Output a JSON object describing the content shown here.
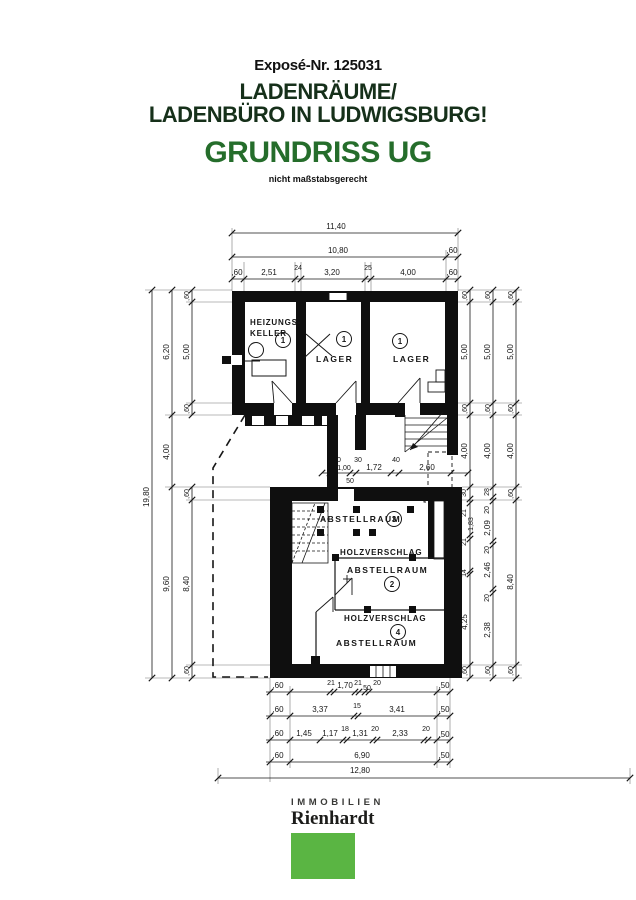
{
  "header": {
    "expose_no": "Exposé-Nr. 125031",
    "title_line1": "LADENRÄUME/",
    "title_line2": "LADENBÜRO IN LUDWIGSBURG!",
    "plan_title": "GRUNDRISS UG",
    "scale_note": "nicht maßstabsgerecht",
    "title_color": "#16301a",
    "plan_title_color": "#256d2b"
  },
  "plan": {
    "rooms": {
      "heizungskeller": {
        "label_line1": "HEIZUNGS-",
        "label_line2": "KELLER",
        "number": "1"
      },
      "lager_1": {
        "label": "LAGER",
        "number": "1"
      },
      "lager_2": {
        "label": "LAGER",
        "number": "1"
      },
      "abstellraum_3": {
        "label": "ABSTELLRAUM",
        "number": "3"
      },
      "holzverschlag_1": {
        "label": "HOLZVERSCHLAG"
      },
      "abstellraum_2": {
        "label": "ABSTELLRAUM",
        "number": "2"
      },
      "holzverschlag_2": {
        "label": "HOLZVERSCHLAG"
      },
      "abstellraum_4": {
        "label": "ABSTELLRAUM",
        "number": "4"
      }
    },
    "dims": {
      "top": {
        "total": "11,40",
        "row2": [
          "10,80",
          ",60"
        ],
        "row3": [
          ",60",
          "2,51",
          "24",
          "3,20",
          "25",
          "4,00",
          ",60"
        ]
      },
      "left": {
        "total": "19,80",
        "mid": [
          "6,20",
          "4,00",
          "9,60"
        ],
        "inner": [
          ",60",
          "5,00",
          ",60",
          ",60",
          "8,40",
          ",60"
        ]
      },
      "right": {
        "chain1": [
          ",60",
          "5,00",
          ",60",
          "4,00",
          "30",
          "21",
          "1,83",
          "21",
          "14",
          "4,25",
          ",60"
        ],
        "chain2": [
          ",60",
          "5,00",
          ",60",
          "4,00",
          "28",
          "20",
          "2,09",
          "20",
          "2,46",
          "20",
          "2,38",
          ",60"
        ],
        "chain3": [
          ",60",
          "5,00",
          ",60",
          "4,00",
          ",60",
          "8,40",
          ",60"
        ]
      },
      "middle": [
        "40",
        "1,00",
        "50",
        "30",
        "1,72",
        "40",
        "2,60"
      ],
      "bottom": {
        "row1": [
          ",60",
          "21",
          "1,70",
          "21",
          "50",
          "20",
          ",50"
        ],
        "row2": [
          ",60",
          "3,37",
          "15",
          "3,41",
          ",50"
        ],
        "row3": [
          ",60",
          "1,45",
          "1,17",
          "18",
          "1,31",
          "20",
          "2,33",
          "20",
          ",50"
        ],
        "row4": [
          ",60",
          "6,90",
          ",50"
        ],
        "total": "12,80"
      }
    }
  },
  "footer": {
    "brand_top": "IMMOBILIEN",
    "brand_name": "Rienhardt",
    "brand_color": "#5ab543"
  }
}
